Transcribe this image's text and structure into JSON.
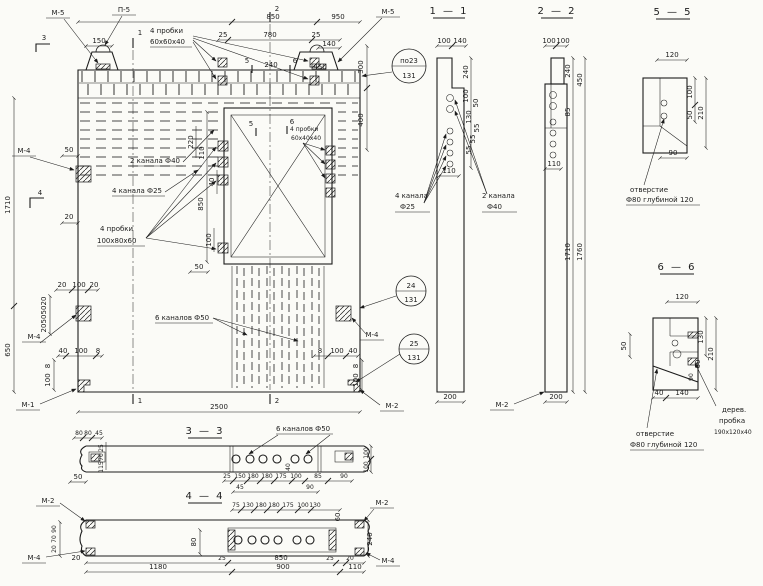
{
  "main": {
    "callout_m5_left": "М-5",
    "callout_p5": "П-5",
    "callout_m5_right": "М-5",
    "callout_m4_left_top": "М-4",
    "callout_m4_left_bottom": "М-4",
    "callout_m4_right": "М-4",
    "callout_m1_bottom_left": "М-1",
    "callout_m2_bottom_right": "М-2",
    "balloon1_top": "по23",
    "balloon1_bottom": "131",
    "balloon2_top": "24",
    "balloon2_bottom": "131",
    "balloon3_top": "25",
    "balloon3_bottom": "131",
    "label_plugs60_line1": "4 пробки",
    "label_plugs60_line2": "60х60х40",
    "label_channels40": "2 канала Ф40",
    "label_channels25": "4 канала Ф25",
    "label_plugs100_line1": "4 пробки",
    "label_plugs100_line2": "100х80х60",
    "label_channels50": "6 каналов Ф50",
    "label_plugs40_line1": "4 пробки",
    "label_plugs40_line2": "60х40х40",
    "mark3": "3",
    "mark4": "4",
    "mark1_top": "1",
    "mark2_top": "2",
    "mark1_bottom": "1",
    "mark2_bottom": "2",
    "mark5_top": "5",
    "mark6_top": "6",
    "mark5_inner": "5",
    "mark6_inner": "6",
    "dim_850": "850",
    "dim_950": "950",
    "dim_25_left": "25",
    "dim_780": "780",
    "dim_25_right": "25",
    "dim_140": "140",
    "dim_150": "150",
    "dim_240": "240",
    "dim_450": "450",
    "dim_300": "300",
    "dim_400": "400",
    "dim_1710": "1710",
    "dim_650": "650",
    "dim_50_insert": "50",
    "dim_20_edge": "20",
    "dim_20a": "20",
    "dim_100a": "100",
    "dim_20b": "20",
    "dim_20c": "20",
    "dim_50a": "50",
    "dim_50b": "50",
    "dim_20d": "20",
    "dim_40a": "40",
    "dim_100b": "100",
    "dim_8a": "8",
    "dim_8b": "8",
    "dim_100c": "100",
    "dim_8c": "8",
    "dim_100d": "100",
    "dim_40b": "40",
    "dim_8d": "8",
    "dim_100e": "100",
    "dim_220": "220",
    "dim_110": "110",
    "dim_40c": "40",
    "dim_850_v": "850",
    "dim_100f": "100",
    "dim_50c": "50",
    "dim_2500": "2500"
  },
  "s11": {
    "title": "1 — 1",
    "dim_100": "100",
    "dim_140": "140",
    "dim_240": "240",
    "dim_100r": "100",
    "dim_50": "50",
    "dim_130": "130",
    "dim_55a": "55",
    "dim_55b": "55",
    "dim_55c": "55",
    "dim_110": "110",
    "dim_200": "200",
    "label_ch25_line1": "4 канала",
    "label_ch25_line2": "Ф25",
    "label_ch40_line1": "2 канала",
    "label_ch40_line2": "Ф40"
  },
  "s22": {
    "title": "2 — 2",
    "dim_100a": "100",
    "dim_100b": "100",
    "dim_240": "240",
    "dim_85": "85",
    "dim_450": "450",
    "dim_1710": "1710",
    "dim_1760": "1760",
    "dim_110": "110",
    "dim_200": "200",
    "callout_m2": "М-2"
  },
  "s55": {
    "title": "5 — 5",
    "dim_120": "120",
    "dim_100": "100",
    "dim_50": "50",
    "dim_210": "210",
    "dim_90": "90",
    "note_line1": "отверстие",
    "note_line2": "Ф80 глубиной 120"
  },
  "s66": {
    "title": "6 — 6",
    "dim_120": "120",
    "dim_50": "50",
    "dim_130": "130",
    "dim_210": "210",
    "dim_60": "60",
    "dim_90": "90",
    "dim_40": "40",
    "dim_140": "140",
    "note_hole_line1": "отверстие",
    "note_hole_line2": "Ф80 глубиной 120",
    "note_plug_line1": "дерев.",
    "note_plug_line2": "пробка",
    "note_plug_line3": "190х120х40"
  },
  "s33": {
    "title": "3 — 3",
    "label_channels": "6 каналов Ф50",
    "dim_80a": "80",
    "dim_80b": "80",
    "dim_45a": "45",
    "dim_25a": "25",
    "dim_70": "70",
    "dim_115": "115",
    "dim_50": "50",
    "dim_25b": "25",
    "dim_150": "150",
    "dim_180a": "180",
    "dim_180b": "180",
    "dim_175": "175",
    "dim_100a": "100",
    "dim_85": "85",
    "dim_90a": "90",
    "dim_45b": "45",
    "dim_90b": "90",
    "dim_40": "40",
    "dim_100r1": "100",
    "dim_100r2": "100"
  },
  "s44": {
    "title": "4 — 4",
    "dim_75": "75",
    "dim_130a": "130",
    "dim_180a": "180",
    "dim_180b": "180",
    "dim_175": "175",
    "dim_100": "100",
    "dim_130b": "130",
    "callout_m2_left": "М-2",
    "callout_m4_left": "М-4",
    "callout_m2_right": "М-2",
    "callout_m4_right": "М-4",
    "dim_90": "90",
    "dim_70": "70",
    "dim_20a": "20",
    "dim_80": "80",
    "dim_60": "60",
    "dim_240": "240",
    "dim_20b": "20",
    "dim_1180": "1180",
    "dim_25a": "25",
    "dim_850": "850",
    "dim_25b": "25",
    "dim_20c": "20",
    "dim_900": "900",
    "dim_110": "110"
  }
}
